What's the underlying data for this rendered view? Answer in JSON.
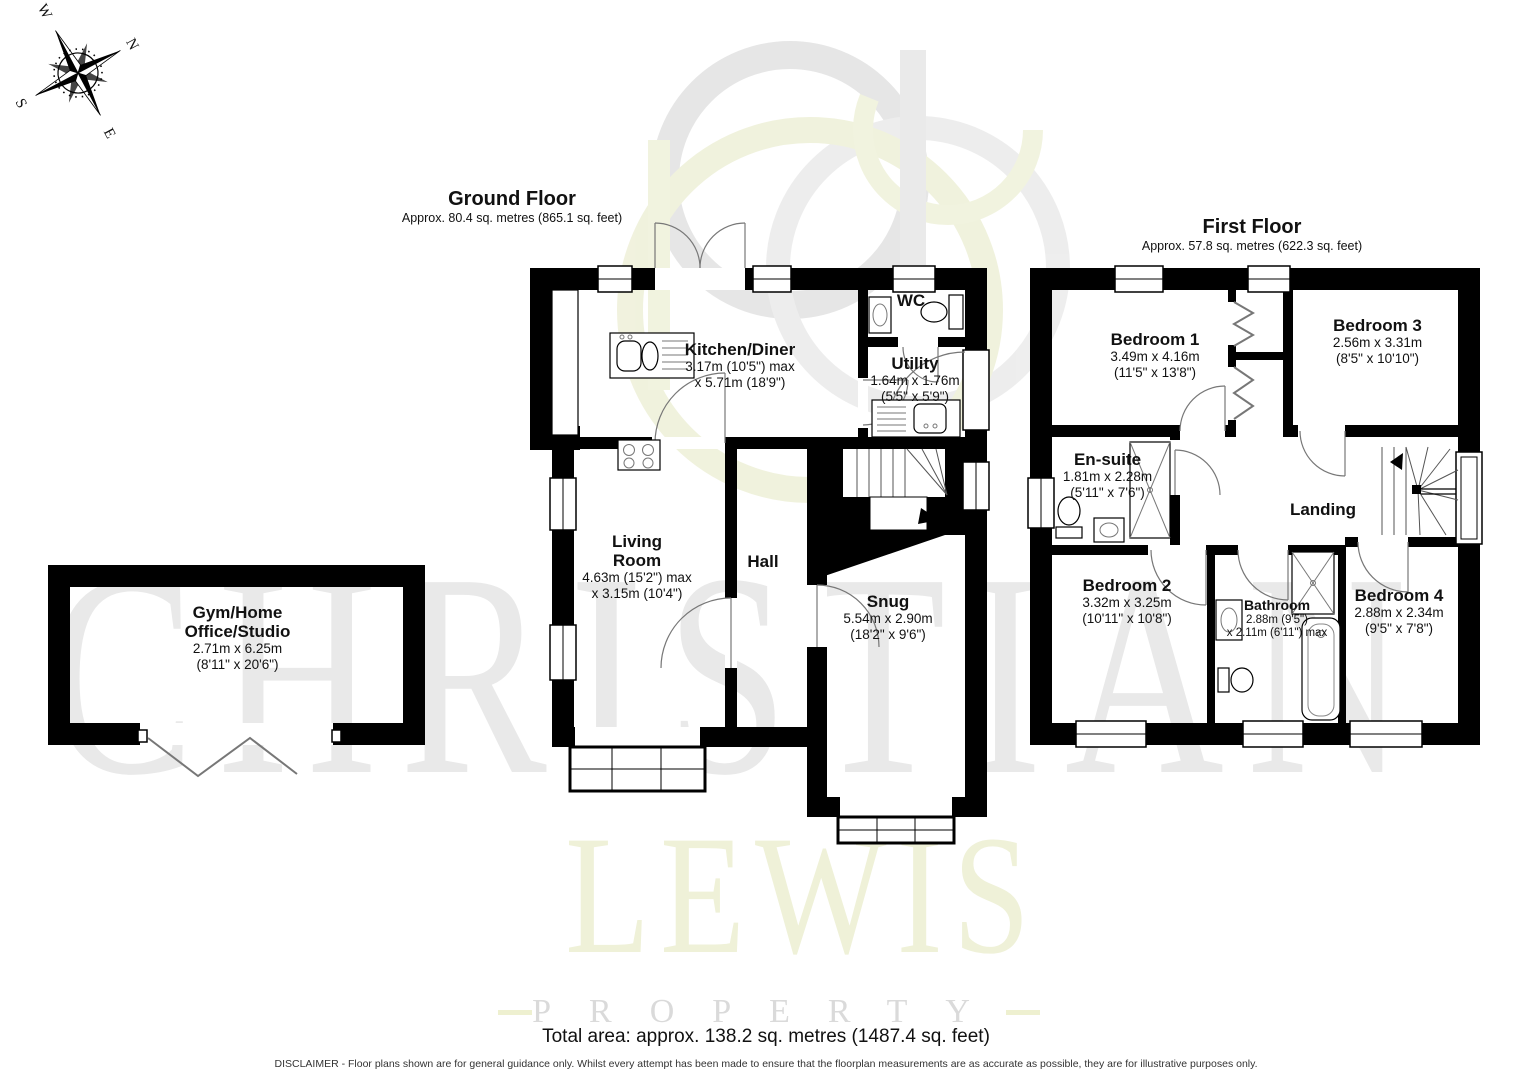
{
  "compass": {
    "n": "N",
    "e": "E",
    "s": "S",
    "w": "W"
  },
  "watermark": {
    "line1": "CHRISTIAN",
    "line2": "LEWIS",
    "line3": "PROPERTY"
  },
  "floors": {
    "ground": {
      "title": "Ground Floor",
      "subtitle": "Approx. 80.4 sq. metres (865.1 sq. feet)"
    },
    "first": {
      "title": "First Floor",
      "subtitle": "Approx. 57.8 sq. metres (622.3 sq. feet)"
    }
  },
  "rooms": {
    "kitchen": {
      "name": "Kitchen/Diner",
      "dim1": "3.17m (10'5\") max",
      "dim2": "x 5.71m (18'9\")"
    },
    "wc": {
      "name": "WC"
    },
    "utility": {
      "name": "Utility",
      "dim1": "1.64m x 1.76m",
      "dim2": "(5'5\" x 5'9\")"
    },
    "living": {
      "name1": "Living",
      "name2": "Room",
      "dim1": "4.63m (15'2\") max",
      "dim2": "x 3.15m (10'4\")"
    },
    "hall": {
      "name": "Hall"
    },
    "snug": {
      "name": "Snug",
      "dim1": "5.54m x 2.90m",
      "dim2": "(18'2\" x 9'6\")"
    },
    "gym": {
      "name1": "Gym/Home",
      "name2": "Office/Studio",
      "dim1": "2.71m x 6.25m",
      "dim2": "(8'11\" x 20'6\")"
    },
    "bedroom1": {
      "name": "Bedroom 1",
      "dim1": "3.49m x 4.16m",
      "dim2": "(11'5\" x 13'8\")"
    },
    "bedroom3": {
      "name": "Bedroom 3",
      "dim1": "2.56m x 3.31m",
      "dim2": "(8'5\" x 10'10\")"
    },
    "ensuite": {
      "name": "En-suite",
      "dim1": "1.81m x 2.28m",
      "dim2": "(5'11\" x 7'6\")"
    },
    "landing": {
      "name": "Landing"
    },
    "bedroom2": {
      "name": "Bedroom 2",
      "dim1": "3.32m x 3.25m",
      "dim2": "(10'11\" x 10'8\")"
    },
    "bathroom": {
      "name": "Bathroom",
      "dim1": "2.88m (9'5\")",
      "dim2": "x 2.11m (6'11\") max"
    },
    "bedroom4": {
      "name": "Bedroom 4",
      "dim1": "2.88m x 2.34m",
      "dim2": "(9'5\" x 7'8\")"
    }
  },
  "footer": {
    "total": "Total area: approx. 138.2 sq. metres (1487.4 sq. feet)",
    "disclaimer": "DISCLAIMER -  Floor plans shown are for general guidance only. Whilst every attempt has been made to ensure that the floorplan measurements are as accurate as possible, they are for illustrative purposes only."
  }
}
